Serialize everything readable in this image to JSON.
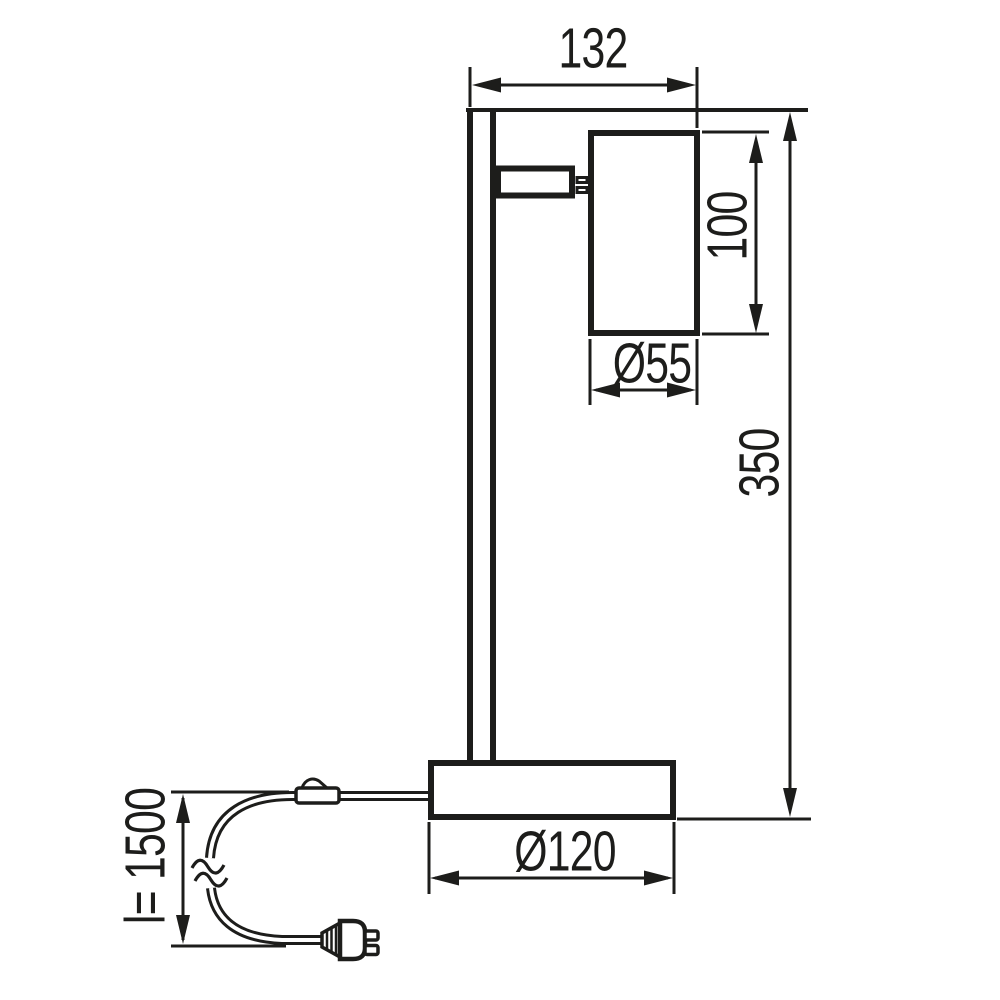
{
  "drawing": {
    "type": "technical-dimension-drawing",
    "subject": "desk spotlight lamp side view with power cord, inline switch and plug",
    "line_color": "#1d1d1b",
    "background_color": "#ffffff",
    "dimensions": [
      {
        "name": "overall-width",
        "label": "132"
      },
      {
        "name": "shade-height",
        "label": "100"
      },
      {
        "name": "shade-diameter",
        "label": "Ø55"
      },
      {
        "name": "lamp-height",
        "label": "350"
      },
      {
        "name": "base-diameter",
        "label": "Ø120"
      },
      {
        "name": "cable-length",
        "label": "l= 1500"
      }
    ]
  }
}
